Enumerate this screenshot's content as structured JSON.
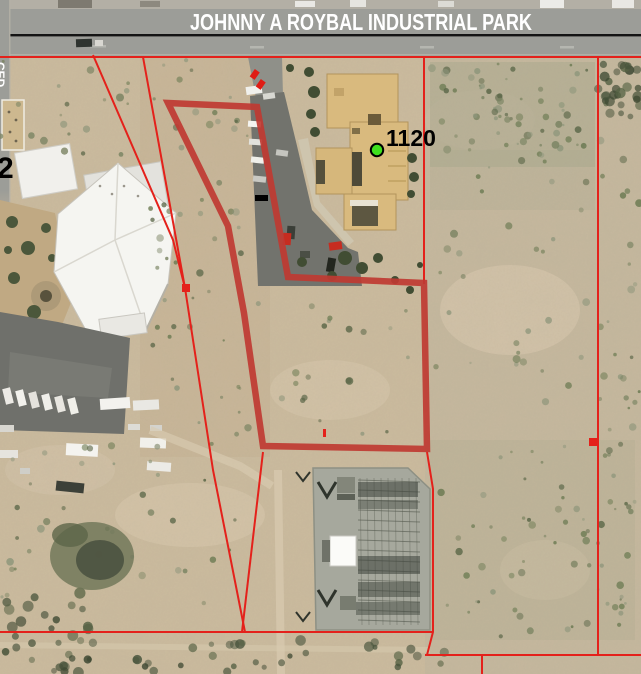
{
  "map": {
    "banner": {
      "street_label": "JOHNNY A ROYBAL INDUSTRIAL PARK"
    },
    "side_street_label": "CED",
    "parcel_number_label": "2",
    "marker": {
      "label": "1120",
      "x": 377,
      "y": 150,
      "color": "#3fe01e",
      "outline": "#000000"
    },
    "colors": {
      "parcel_highlight": "#bf3a32",
      "parcel_line": "#e4211b",
      "road": "#9c9d98",
      "desert": "#ccbb9e",
      "banner_text": "#ffffff"
    },
    "parcel_highlight": {
      "points": [
        [
          168,
          103
        ],
        [
          257,
          107
        ],
        [
          288,
          277
        ],
        [
          424,
          283
        ],
        [
          427,
          449
        ],
        [
          263,
          446
        ],
        [
          244,
          313
        ],
        [
          228,
          226
        ]
      ]
    },
    "parcel_lines": {
      "polylines": [
        [
          [
            0,
            57
          ],
          [
            641,
            57
          ]
        ],
        [
          [
            598,
            57
          ],
          [
            598,
            655
          ]
        ],
        [
          [
            425,
            655
          ],
          [
            641,
            655
          ]
        ],
        [
          [
            482,
            655
          ],
          [
            482,
            674
          ]
        ],
        [
          [
            424,
            57
          ],
          [
            424,
            284
          ]
        ],
        [
          [
            0,
            632
          ],
          [
            433,
            632
          ]
        ],
        [
          [
            427,
            452
          ],
          [
            433,
            489
          ],
          [
            433,
            632
          ],
          [
            427,
            655
          ]
        ],
        [
          [
            263,
            452
          ],
          [
            242,
            632
          ]
        ],
        [
          [
            93,
            55
          ],
          [
            173,
            240
          ],
          [
            185,
            288
          ]
        ],
        [
          [
            143,
            57
          ],
          [
            185,
            288
          ]
        ],
        [
          [
            185,
            288
          ],
          [
            213,
            470
          ],
          [
            245,
            632
          ]
        ]
      ]
    },
    "red_marks": {
      "squares": [
        [
          182,
          284
        ],
        [
          589,
          438
        ]
      ],
      "ticks": [
        [
          323,
          429
        ]
      ]
    }
  }
}
